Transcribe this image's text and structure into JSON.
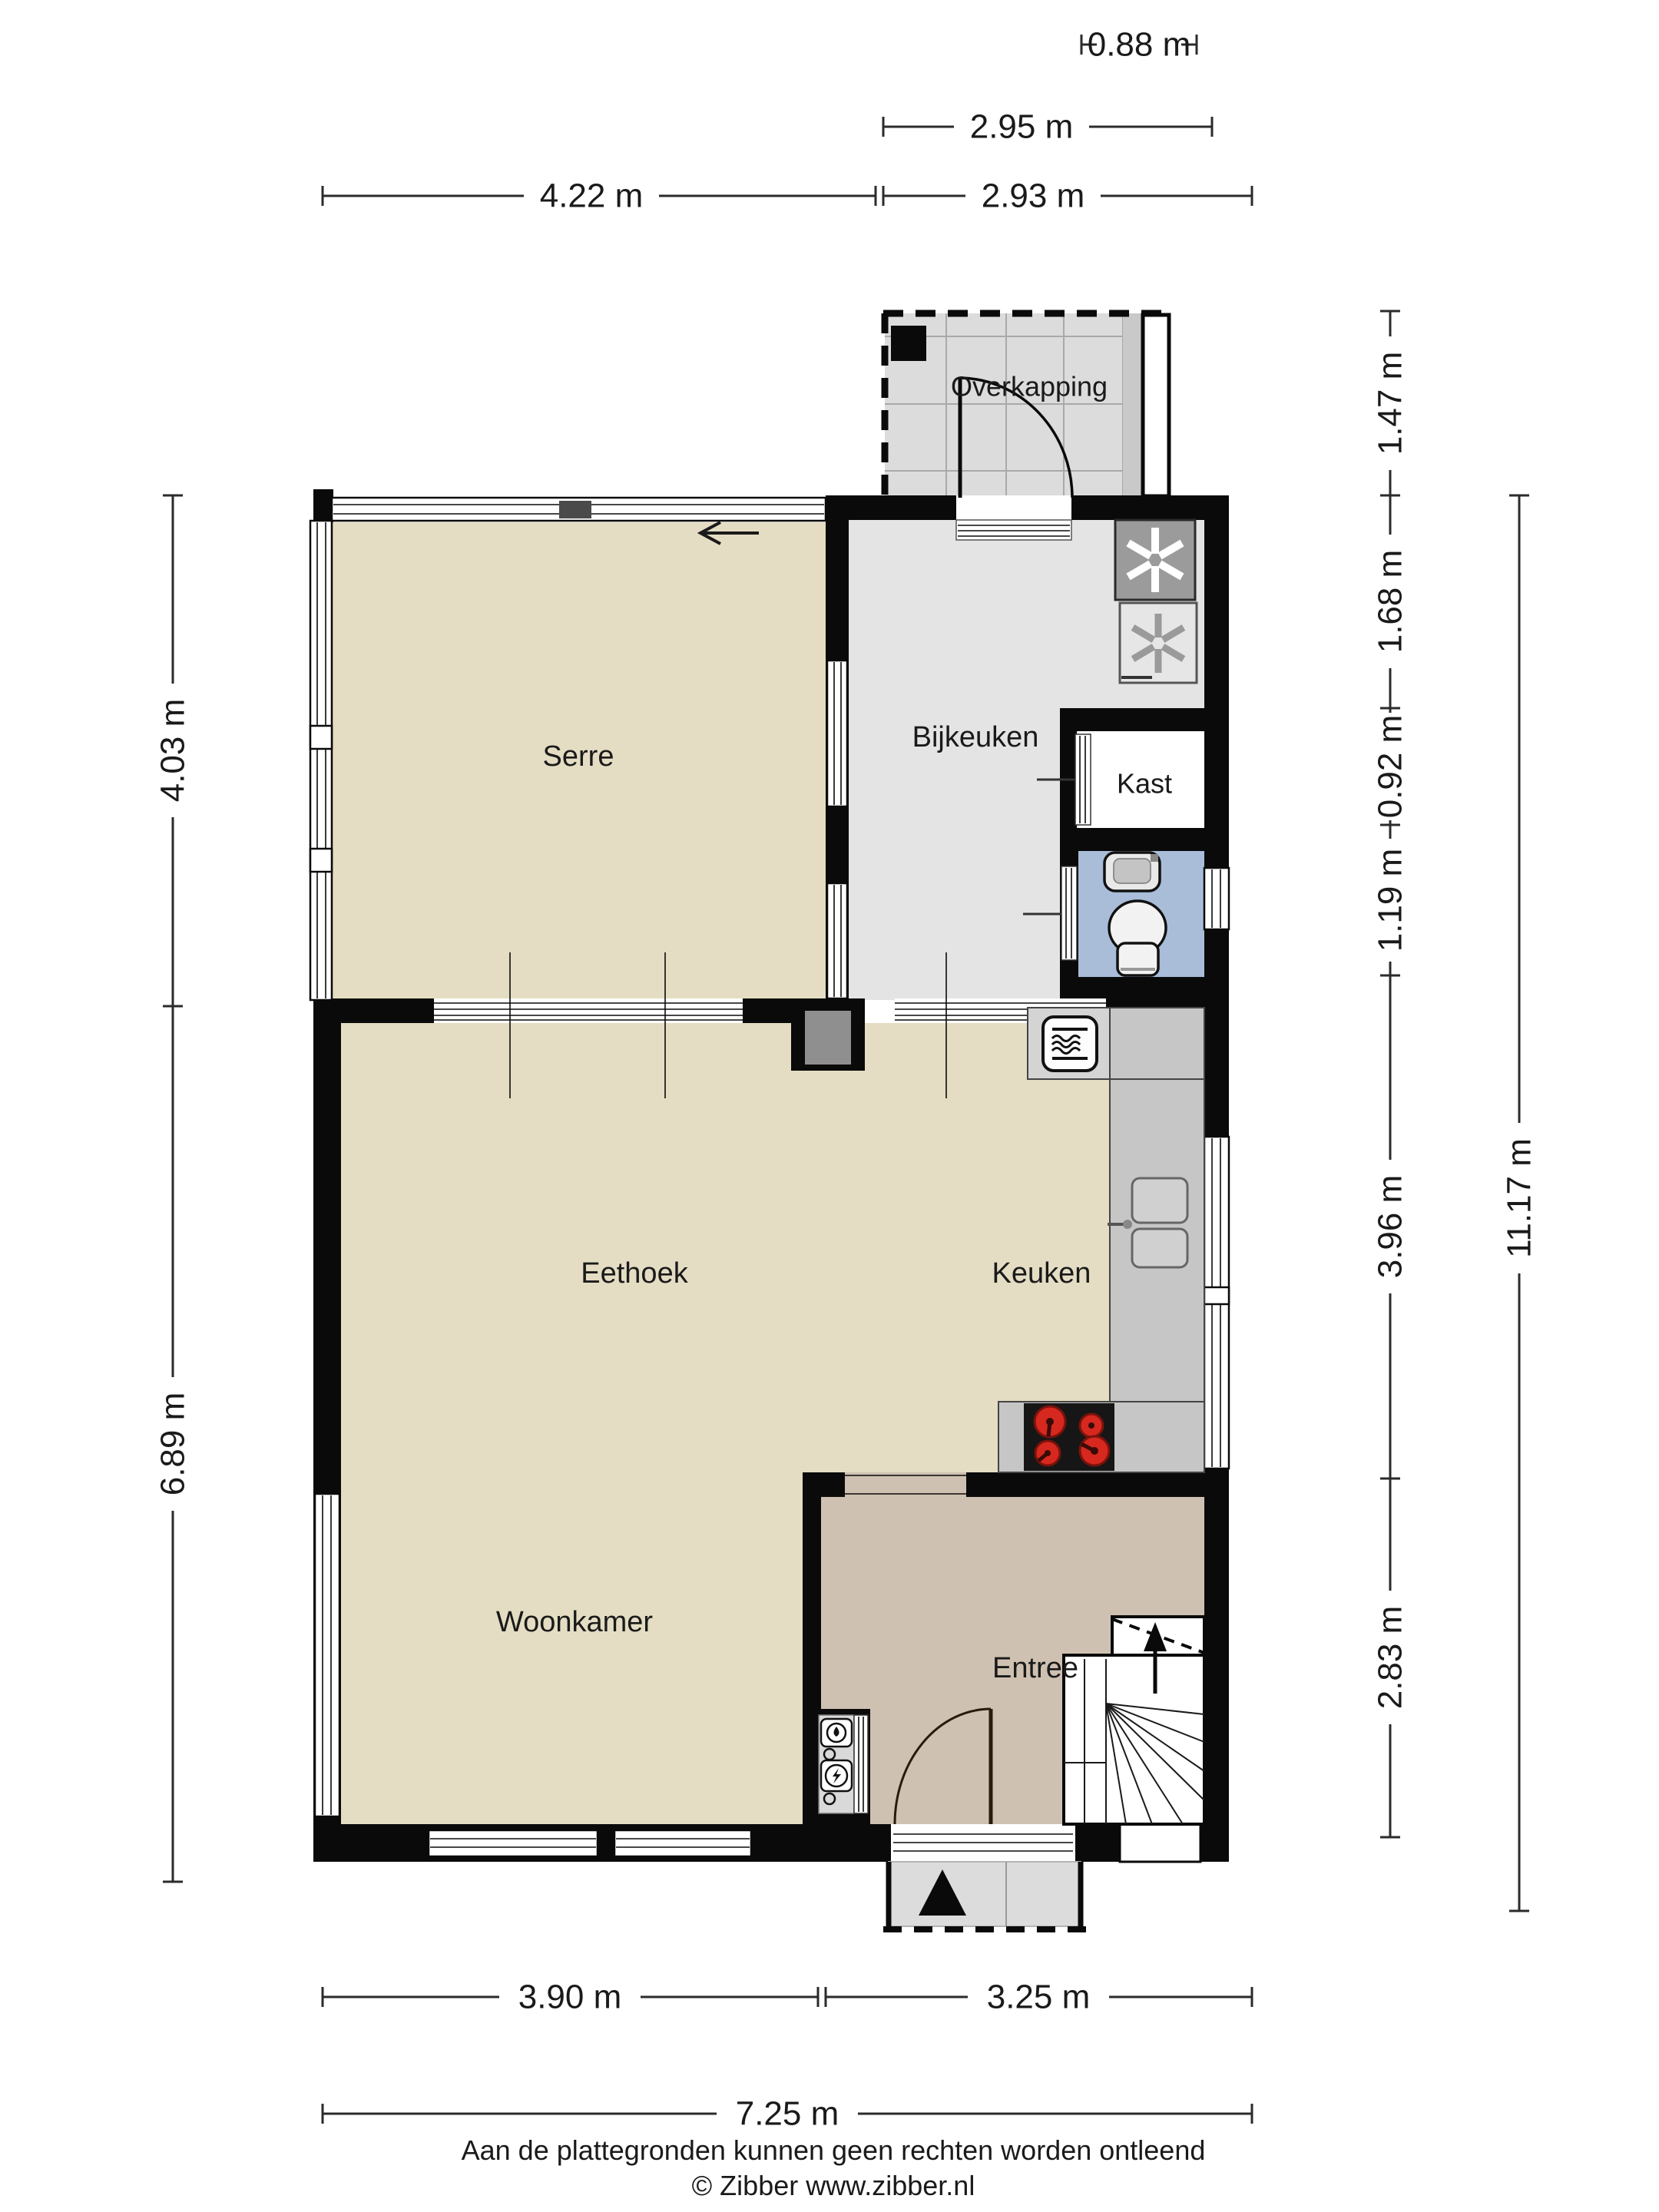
{
  "rooms": {
    "overkapping": "Overkapping",
    "serre": "Serre",
    "bijkeuken": "Bijkeuken",
    "kast": "Kast",
    "eethoek": "Eethoek",
    "keuken": "Keuken",
    "woonkamer": "Woonkamer",
    "entree": "Entree"
  },
  "dimensions": {
    "top_small": "0.88 m",
    "top_overkapping": "2.95 m",
    "top_serre": "4.22 m",
    "top_right": "2.93 m",
    "left_upper": "4.03 m",
    "left_lower": "6.89 m",
    "right_overkapping": "1.47 m",
    "right_bijkeuken": "1.68 m",
    "right_kast": "0.92 m",
    "right_toilet": "1.19 m",
    "right_keuken": "3.96 m",
    "right_entree": "2.83 m",
    "right_total": "11.17 m",
    "bottom_left": "3.90 m",
    "bottom_right": "3.25 m",
    "bottom_total": "7.25 m"
  },
  "footer": {
    "line1": "Aan de plattegronden kunnen geen rechten worden ontleend",
    "line2": "© Zibber www.zibber.nl"
  },
  "icons": [
    "washing-machine-icon",
    "dryer-icon",
    "microwave-icon",
    "stove-icon",
    "kitchen-sink-icon",
    "toilet-icon",
    "washbasin-icon",
    "water-meter-icon",
    "electricity-meter-icon",
    "stairs-up-arrow-icon",
    "entrance-arrow-icon",
    "door-swing-icon",
    "sliding-door-arrow-icon"
  ],
  "colors": {
    "wall": "#0a0a0a",
    "floor_living": "#e4ddc3",
    "floor_utility": "#e4e4e4",
    "floor_entree": "#cfc1b1",
    "floor_toilet": "#a9bdd9",
    "floor_overkapping": "#dcdcdc",
    "counter": "#c6c6c6",
    "stove": "#161616",
    "burner": "#d6281e",
    "porch": "#dcdcdc"
  }
}
